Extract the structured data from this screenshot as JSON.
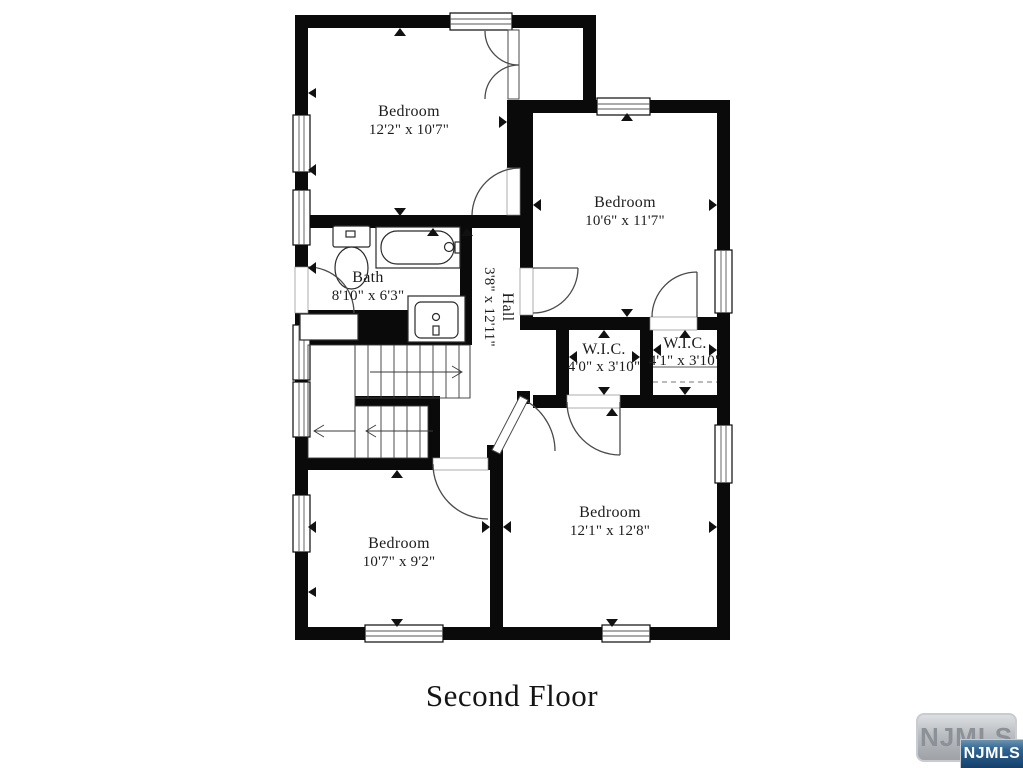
{
  "floor_plan": {
    "title": "Second Floor",
    "rooms": [
      {
        "name": "Bedroom",
        "dims": "12'2\" x 10'7\""
      },
      {
        "name": "Bedroom",
        "dims": "10'6\" x 11'7\""
      },
      {
        "name": "Bath",
        "dims": "8'10\" x 6'3\""
      },
      {
        "name": "Hall",
        "dims": "3'8\" x 12'11\""
      },
      {
        "name": "W.I.C.",
        "dims": "4'0\" x 3'10\""
      },
      {
        "name": "W.I.C.",
        "dims": "4'1\" x 3'10\""
      },
      {
        "name": "Bedroom",
        "dims": "10'7\" x 9'2\""
      },
      {
        "name": "Bedroom",
        "dims": "12'1\" x 12'8\""
      }
    ],
    "watermark": {
      "back_label": "NJMLS",
      "front_label": "NJMLS"
    },
    "colors": {
      "wall": "#0a0a0a",
      "line": "#4a4a4a",
      "text": "#1c1c1c",
      "watermark_blue": "#2e6492",
      "watermark_silver": "#b9bdc1"
    }
  }
}
